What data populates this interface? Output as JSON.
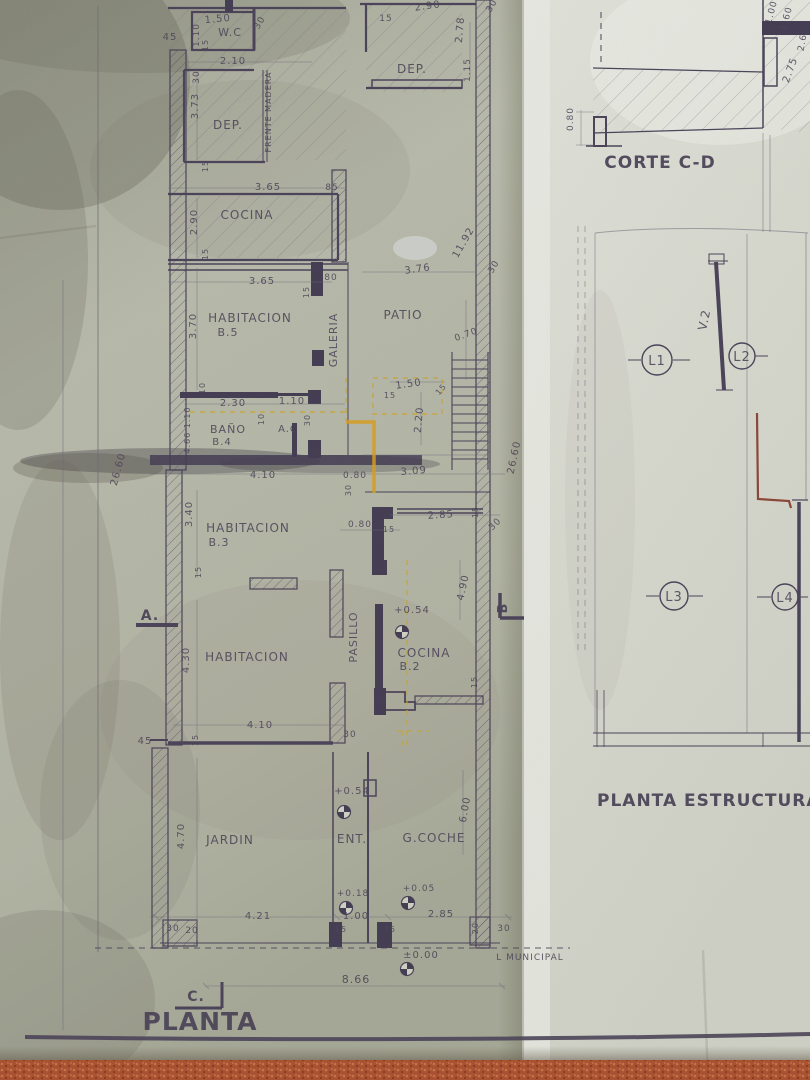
{
  "photo": {
    "subject": "aged architectural blueprint photographed on a terracotta floor",
    "floor_color": "#a9502f"
  },
  "colors": {
    "ink": "#4a4258",
    "pencil": "#6b6878",
    "paper_left": "#b3b5a6",
    "paper_right": "#d6d7cf",
    "highlight_yellow": "#c8a431",
    "red_pen": "#7e2b1c"
  },
  "plan": {
    "title": "PLANTA",
    "labels": [
      {
        "t": "45",
        "x": 170,
        "y": 40,
        "s": 10
      },
      {
        "t": "1.50",
        "x": 218,
        "y": 22,
        "s": 10,
        "r": -5
      },
      {
        "t": "1.10",
        "x": 199,
        "y": 35,
        "s": 9,
        "r": -90
      },
      {
        "t": "15",
        "x": 208,
        "y": 45,
        "s": 8,
        "r": -90
      },
      {
        "t": "W.C",
        "x": 230,
        "y": 36,
        "s": 11,
        "n": "room-wc"
      },
      {
        "t": "30",
        "x": 262,
        "y": 24,
        "s": 9,
        "r": -60
      },
      {
        "t": "2.10",
        "x": 233,
        "y": 64,
        "s": 10
      },
      {
        "t": "30",
        "x": 199,
        "y": 77,
        "s": 9,
        "r": -90
      },
      {
        "t": "3.73",
        "x": 198,
        "y": 106,
        "s": 10,
        "r": -90
      },
      {
        "t": "DEP.",
        "x": 228,
        "y": 129,
        "s": 12,
        "n": "room-dep-1"
      },
      {
        "t": "FRENTE MADERA",
        "x": 271,
        "y": 112,
        "s": 8,
        "r": -90
      },
      {
        "t": "15",
        "x": 208,
        "y": 166,
        "s": 8,
        "r": -90
      },
      {
        "t": "3.65",
        "x": 268,
        "y": 190,
        "s": 10
      },
      {
        "t": "85",
        "x": 332,
        "y": 190,
        "s": 9
      },
      {
        "t": "COCINA",
        "x": 247,
        "y": 219,
        "s": 12,
        "n": "room-cocina"
      },
      {
        "t": "2.90",
        "x": 197,
        "y": 222,
        "s": 10,
        "r": -90
      },
      {
        "t": "15",
        "x": 208,
        "y": 254,
        "s": 8,
        "r": -90
      },
      {
        "t": "DEP.",
        "x": 412,
        "y": 73,
        "s": 12,
        "n": "room-dep-2"
      },
      {
        "t": "2.90",
        "x": 428,
        "y": 9,
        "s": 10,
        "r": -8
      },
      {
        "t": "15",
        "x": 386,
        "y": 21,
        "s": 9
      },
      {
        "t": "2.78",
        "x": 463,
        "y": 30,
        "s": 10,
        "r": -85
      },
      {
        "t": "1.15",
        "x": 470,
        "y": 70,
        "s": 9,
        "r": -90
      },
      {
        "t": "30",
        "x": 494,
        "y": 7,
        "s": 9,
        "r": -60
      },
      {
        "t": "11.92",
        "x": 466,
        "y": 244,
        "s": 10,
        "r": -60
      },
      {
        "t": "30",
        "x": 496,
        "y": 268,
        "s": 9,
        "r": -60
      },
      {
        "t": "3.76",
        "x": 418,
        "y": 272,
        "s": 10,
        "r": -8
      },
      {
        "t": "3.65",
        "x": 262,
        "y": 284,
        "s": 10
      },
      {
        "t": "80",
        "x": 331,
        "y": 280,
        "s": 9
      },
      {
        "t": "15",
        "x": 309,
        "y": 292,
        "s": 8,
        "r": -90
      },
      {
        "t": "HABITACION",
        "x": 250,
        "y": 322,
        "s": 12,
        "n": "room-habitacion-b5"
      },
      {
        "t": "B.5",
        "x": 228,
        "y": 336,
        "s": 11
      },
      {
        "t": "3.70",
        "x": 196,
        "y": 326,
        "s": 10,
        "r": -90
      },
      {
        "t": "GALERIA",
        "x": 337,
        "y": 340,
        "s": 11,
        "r": -90,
        "n": "room-galeria"
      },
      {
        "t": "PATIO",
        "x": 403,
        "y": 319,
        "s": 12,
        "n": "room-patio"
      },
      {
        "t": "0.70",
        "x": 467,
        "y": 337,
        "s": 9,
        "r": -20
      },
      {
        "t": "10",
        "x": 205,
        "y": 388,
        "s": 8,
        "r": -90
      },
      {
        "t": "2.30",
        "x": 233,
        "y": 406,
        "s": 10
      },
      {
        "t": "1.10",
        "x": 292,
        "y": 404,
        "s": 10
      },
      {
        "t": "10",
        "x": 264,
        "y": 419,
        "s": 8,
        "r": -90
      },
      {
        "t": "30",
        "x": 310,
        "y": 420,
        "s": 8,
        "r": -90
      },
      {
        "t": "BAÑO",
        "x": 228,
        "y": 433,
        "s": 11,
        "n": "room-banio-b4"
      },
      {
        "t": "B.4",
        "x": 222,
        "y": 445,
        "s": 10
      },
      {
        "t": "A.C",
        "x": 288,
        "y": 432,
        "s": 10,
        "n": "room-ac"
      },
      {
        "t": "4.66 1.10",
        "x": 190,
        "y": 430,
        "s": 8,
        "r": -90
      },
      {
        "t": "26.60",
        "x": 121,
        "y": 470,
        "s": 10,
        "r": -75
      },
      {
        "t": "1.50",
        "x": 409,
        "y": 387,
        "s": 10,
        "r": -8
      },
      {
        "t": "15",
        "x": 390,
        "y": 398,
        "s": 8
      },
      {
        "t": "15",
        "x": 443,
        "y": 391,
        "s": 8,
        "r": -50
      },
      {
        "t": "2.20",
        "x": 422,
        "y": 420,
        "s": 10,
        "r": -85
      },
      {
        "t": "4.10",
        "x": 263,
        "y": 478,
        "s": 10
      },
      {
        "t": "0.80",
        "x": 355,
        "y": 478,
        "s": 9
      },
      {
        "t": "30",
        "x": 351,
        "y": 490,
        "s": 8,
        "r": -90
      },
      {
        "t": "3.09",
        "x": 414,
        "y": 474,
        "s": 10,
        "r": -5
      },
      {
        "t": "26.60",
        "x": 517,
        "y": 458,
        "s": 10,
        "r": -78
      },
      {
        "t": "HABITACION",
        "x": 248,
        "y": 532,
        "s": 12,
        "n": "room-habitacion-b3"
      },
      {
        "t": "B.3",
        "x": 219,
        "y": 546,
        "s": 11
      },
      {
        "t": "3.40",
        "x": 192,
        "y": 514,
        "s": 10,
        "r": -90
      },
      {
        "t": "0.80",
        "x": 360,
        "y": 527,
        "s": 9
      },
      {
        "t": "15",
        "x": 389,
        "y": 532,
        "s": 8
      },
      {
        "t": "2.85",
        "x": 441,
        "y": 518,
        "s": 10,
        "r": -4
      },
      {
        "t": "15",
        "x": 478,
        "y": 512,
        "s": 8,
        "r": -90
      },
      {
        "t": "30",
        "x": 497,
        "y": 526,
        "s": 9,
        "r": -45
      },
      {
        "t": "15",
        "x": 201,
        "y": 572,
        "s": 8,
        "r": -90
      },
      {
        "t": "A.",
        "x": 150,
        "y": 620,
        "s": 14,
        "b": 1,
        "n": "section-marker-a"
      },
      {
        "t": "4.90",
        "x": 466,
        "y": 588,
        "s": 10,
        "r": -78
      },
      {
        "t": "B",
        "x": 507,
        "y": 608,
        "s": 13,
        "r": -90,
        "b": 1,
        "n": "section-marker-b"
      },
      {
        "t": "4.30",
        "x": 189,
        "y": 660,
        "s": 10,
        "r": -90
      },
      {
        "t": "HABITACION",
        "x": 247,
        "y": 661,
        "s": 12,
        "n": "room-habitacion-2"
      },
      {
        "t": "PASILLO",
        "x": 357,
        "y": 637,
        "s": 11,
        "r": -90,
        "n": "room-pasillo"
      },
      {
        "t": "+0.54",
        "x": 412,
        "y": 613,
        "s": 10,
        "n": "level-plus054-cocina"
      },
      {
        "t": "COCINA",
        "x": 424,
        "y": 657,
        "s": 12,
        "n": "room-cocina-b2"
      },
      {
        "t": "B.2",
        "x": 410,
        "y": 670,
        "s": 11
      },
      {
        "t": "15",
        "x": 477,
        "y": 682,
        "s": 8,
        "r": -90
      },
      {
        "t": "4.10",
        "x": 260,
        "y": 728,
        "s": 10
      },
      {
        "t": "15",
        "x": 198,
        "y": 740,
        "s": 8,
        "r": -90
      },
      {
        "t": "45",
        "x": 145,
        "y": 744,
        "s": 10
      },
      {
        "t": "30",
        "x": 350,
        "y": 737,
        "s": 9
      },
      {
        "t": "JARDIN",
        "x": 230,
        "y": 844,
        "s": 12,
        "n": "room-jardin"
      },
      {
        "t": "4.70",
        "x": 184,
        "y": 836,
        "s": 10,
        "r": -90
      },
      {
        "t": "ENT.",
        "x": 352,
        "y": 843,
        "s": 12,
        "n": "room-ent"
      },
      {
        "t": "G.COCHE",
        "x": 434,
        "y": 842,
        "s": 12,
        "n": "room-gcoche"
      },
      {
        "t": "6.00",
        "x": 468,
        "y": 810,
        "s": 10,
        "r": -80
      },
      {
        "t": "+0.54",
        "x": 352,
        "y": 794,
        "s": 10,
        "n": "level-plus054-ent"
      },
      {
        "t": "+0.18",
        "x": 353,
        "y": 896,
        "s": 9,
        "n": "level-plus018"
      },
      {
        "t": "+0.05",
        "x": 419,
        "y": 891,
        "s": 9,
        "n": "level-plus005"
      },
      {
        "t": "4.21",
        "x": 258,
        "y": 919,
        "s": 10
      },
      {
        "t": "1.00",
        "x": 356,
        "y": 919,
        "s": 10
      },
      {
        "t": "2.85",
        "x": 441,
        "y": 917,
        "s": 10
      },
      {
        "t": "30",
        "x": 173,
        "y": 931,
        "s": 9
      },
      {
        "t": "20",
        "x": 192,
        "y": 933,
        "s": 9
      },
      {
        "t": "15",
        "x": 341,
        "y": 932,
        "s": 8
      },
      {
        "t": "15",
        "x": 390,
        "y": 932,
        "s": 8
      },
      {
        "t": "20",
        "x": 478,
        "y": 928,
        "s": 8,
        "r": -90
      },
      {
        "t": "30",
        "x": 504,
        "y": 931,
        "s": 9
      },
      {
        "t": "±0.00",
        "x": 421,
        "y": 958,
        "s": 10,
        "n": "level-pm000"
      },
      {
        "t": "L MUNICIPAL",
        "x": 530,
        "y": 960,
        "s": 9,
        "n": "linea-municipal"
      },
      {
        "t": "8.66",
        "x": 356,
        "y": 983,
        "s": 11
      },
      {
        "t": "C.",
        "x": 196,
        "y": 1001,
        "s": 14,
        "b": 1,
        "n": "section-marker-c"
      }
    ]
  },
  "structure": {
    "corte_title": "CORTE C-D",
    "title": "PLANTA ESTRUCTURA",
    "beam_label": "V.2",
    "columns": [
      {
        "label": "L1"
      },
      {
        "label": "L2"
      },
      {
        "label": "L3"
      },
      {
        "label": "L4"
      }
    ],
    "labels": [
      {
        "t": "0.80",
        "x": 573,
        "y": 119,
        "s": 9,
        "r": -90
      },
      {
        "t": "1.00",
        "x": 774,
        "y": 13,
        "s": 9,
        "r": -75
      },
      {
        "t": "1.60",
        "x": 789,
        "y": 19,
        "s": 9,
        "r": -75
      },
      {
        "t": "2.6",
        "x": 805,
        "y": 43,
        "s": 9,
        "r": -80
      },
      {
        "t": "2.75",
        "x": 793,
        "y": 71,
        "s": 10,
        "r": -70
      }
    ]
  }
}
